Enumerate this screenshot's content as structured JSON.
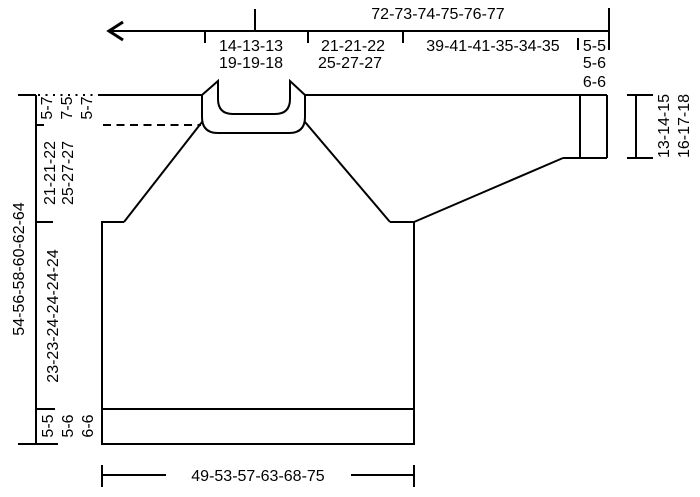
{
  "diagram_type": "knitting-pattern-schematic-raglan-sweater",
  "colors": {
    "line": "#000000",
    "background": "#ffffff"
  },
  "labels": {
    "top": {
      "total_width": "72-73-74-75-76-77",
      "back_neck": [
        "14-13-13",
        "19-19-18"
      ],
      "sleeve_top": [
        "21-21-22",
        "25-27-27"
      ],
      "sleeve_length": "39-41-41-35-34-35",
      "cuff_rib": [
        "5-5",
        "5-6",
        "6-6"
      ]
    },
    "left": {
      "total_length": "54-56-58-60-62-64",
      "neck_depth": [
        "5-7",
        "7-5",
        "5-7"
      ],
      "yoke_depth": [
        "21-21-22",
        "25-27-27"
      ],
      "body_length": "23-23-24-24-24-24",
      "bottom_rib": [
        "5-5",
        "5-6",
        "6-6"
      ]
    },
    "right": {
      "cuff_width": [
        "13-14-15",
        "16-17-18"
      ]
    },
    "bottom": {
      "body_width": "49-53-57-63-68-75"
    }
  }
}
